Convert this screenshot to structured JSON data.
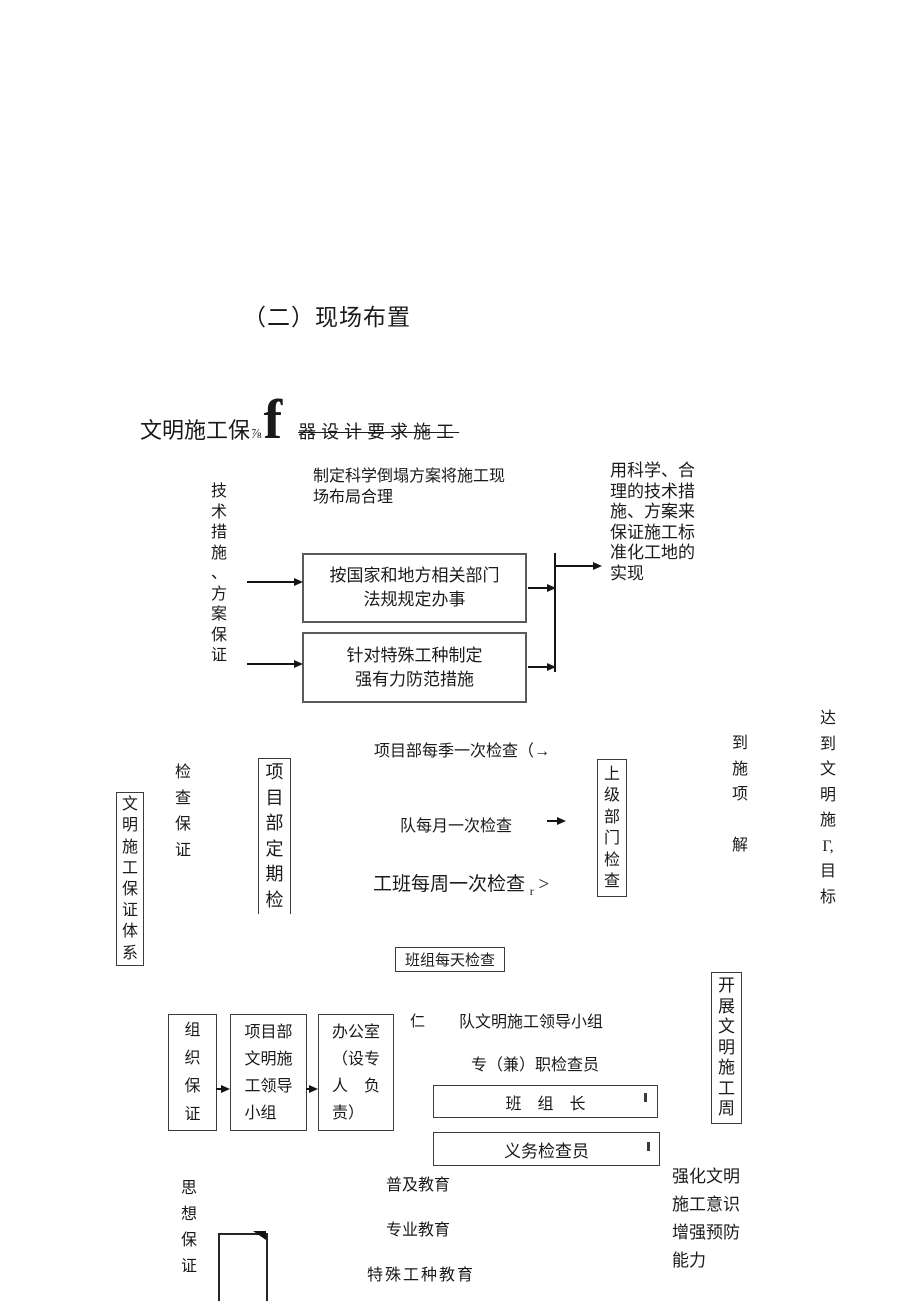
{
  "page": {
    "title": "（二）现场布置"
  },
  "header": {
    "main": "文明施工保",
    "fraction": "⅞",
    "glyph": "f",
    "strike": "器设计要求施工"
  },
  "tech": {
    "side_label": "技\n术\n措\n施\n、\n方\n案\n保\n证",
    "note": "制定科学倒塌方案将施工现\n场布局合理",
    "box1": "按国家和地方相关部门\n法规规定办事",
    "box2": "针对特殊工种制定\n强有力防范措施",
    "result": "用科学、合\n理的技术措\n施、方案来\n保证施工标\n准化工地的\n实现"
  },
  "check": {
    "system_label": "文\n明\n施\n工\n保\n证\n体\n系",
    "side_label": "检\n查\n保\n证",
    "periodic_box": "项\n目\n部\n定\n期\n检",
    "quarterly": "项目部每季一次检查（→",
    "monthly": "队每月一次检查",
    "weekly": "工班每周一次检查",
    "weekly_sub": "r",
    "weekly_close": ">",
    "daily_box": "班组每天检查",
    "upper_box": "上\n级\n部\n门\n检\n查",
    "mid_note": "到\n施\n项\n\n解",
    "goal": "达\n到\n文\n明\n施\nΓ,\n目\n标"
  },
  "org": {
    "side_label": "组\n织\n保\n证",
    "leader_box": "项目部\n文明施\n工领导\n小组",
    "office_box": "办公室\n（设专\n人　负\n责）",
    "stray": "仁",
    "team_group": "队文明施工领导小组",
    "inspector": "专（兼）职检查员",
    "foreman_box": "班　组　长",
    "volunteer_box": "义务检查员",
    "week_box": "开\n展\n文\n明\n施\n工\n周",
    "effect": "强化文明\n施工意识\n增强预防\n能力"
  },
  "edu": {
    "side_label": "思\n想\n保\n证",
    "items": [
      "普及教育",
      "专业教育",
      "特殊工种教育"
    ]
  }
}
